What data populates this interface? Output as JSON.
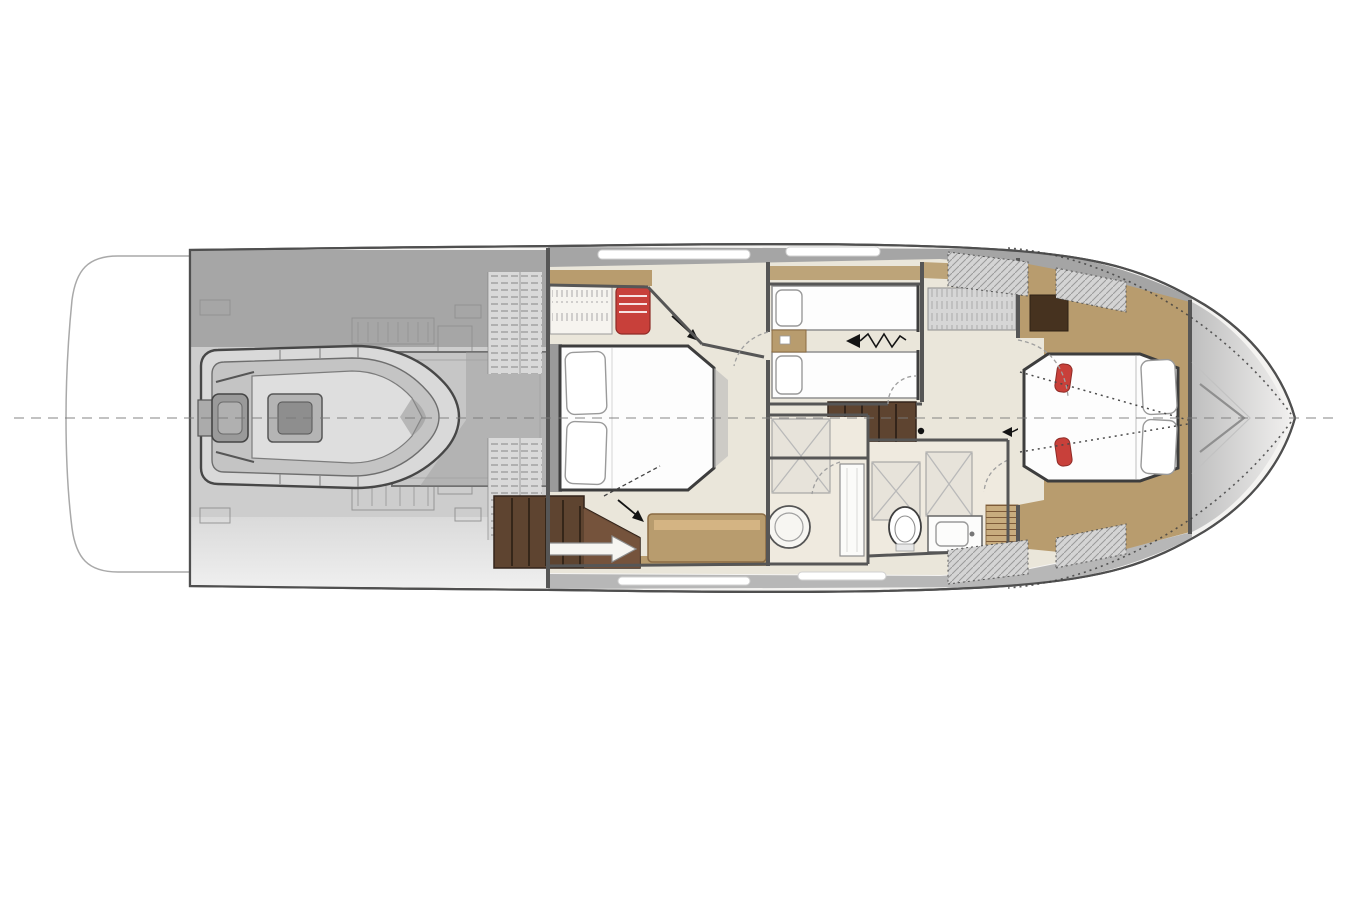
{
  "diagram": {
    "type": "yacht-lower-deck-floor-plan",
    "orientation": "bow-right",
    "rooms": [
      {
        "name": "swim-platform",
        "contains": []
      },
      {
        "name": "aft-deck-tender-garage",
        "contains": [
          "tender-with-outboard-engine",
          "garage-frame",
          "machinery-outlines",
          "boarding-step-hatches"
        ]
      },
      {
        "name": "master-cabin-aft",
        "contains": [
          "double-bed",
          "two-pillows",
          "hanging-wardrobe",
          "red-vanity-stool",
          "sofa-bench",
          "companionway-stairs",
          "white-direction-arrow",
          "door-arrows"
        ]
      },
      {
        "name": "twin-guest-cabin",
        "contains": [
          "twin-bed-upper",
          "twin-bed-lower",
          "nightstand",
          "bed-slide-zigzag-arrow"
        ]
      },
      {
        "name": "midship-landing",
        "contains": [
          "stairs-up",
          "pivot-dot"
        ]
      },
      {
        "name": "bathroom-aft",
        "contains": [
          "shower-panel",
          "round-basin",
          "door-panel"
        ]
      },
      {
        "name": "bathroom-forward",
        "contains": [
          "shower-panels",
          "toilet",
          "vanity-sink"
        ]
      },
      {
        "name": "vip-cabin-bow",
        "contains": [
          "island-bed",
          "two-pillows",
          "red-accent-cushions",
          "dark-wardrobe",
          "deck-edge-dotted-lines",
          "step-hatch"
        ]
      },
      {
        "name": "bow-deck",
        "contains": [
          "bow-chevron"
        ]
      }
    ],
    "annotations": [
      "dashed-centerline",
      "dotted-deck-edge-at-bow",
      "door-swing-arcs",
      "hull-windows"
    ]
  },
  "palette": {
    "paper": "#ffffff",
    "outline": "#4f4f4f",
    "wall": "#565656",
    "deck_dark": "#a6a6a6",
    "deck_mid": "#cdcdcd",
    "deck_light": "#e0e0e0",
    "band_gray": "#a5a5a5",
    "band_gray_btm": "#b7b7b7",
    "floor_cream": "#eae6da",
    "floor_bath": "#efeadf",
    "wood": "#b89c6e",
    "wood_dark": "#8a6b43",
    "stairs_brown": "#5e4430",
    "stairs_edge": "#33241a",
    "stairs_light": "#7a5740",
    "wardrobe_dark": "#46321f",
    "accent_red": "#c8403a",
    "bed_white": "#fdfdfd",
    "line_gray": "#9a9a9a",
    "tender_tube": "#d9d9d9",
    "tender_inner": "#c4c4c4",
    "engine_gray": "#9a9a9a"
  }
}
